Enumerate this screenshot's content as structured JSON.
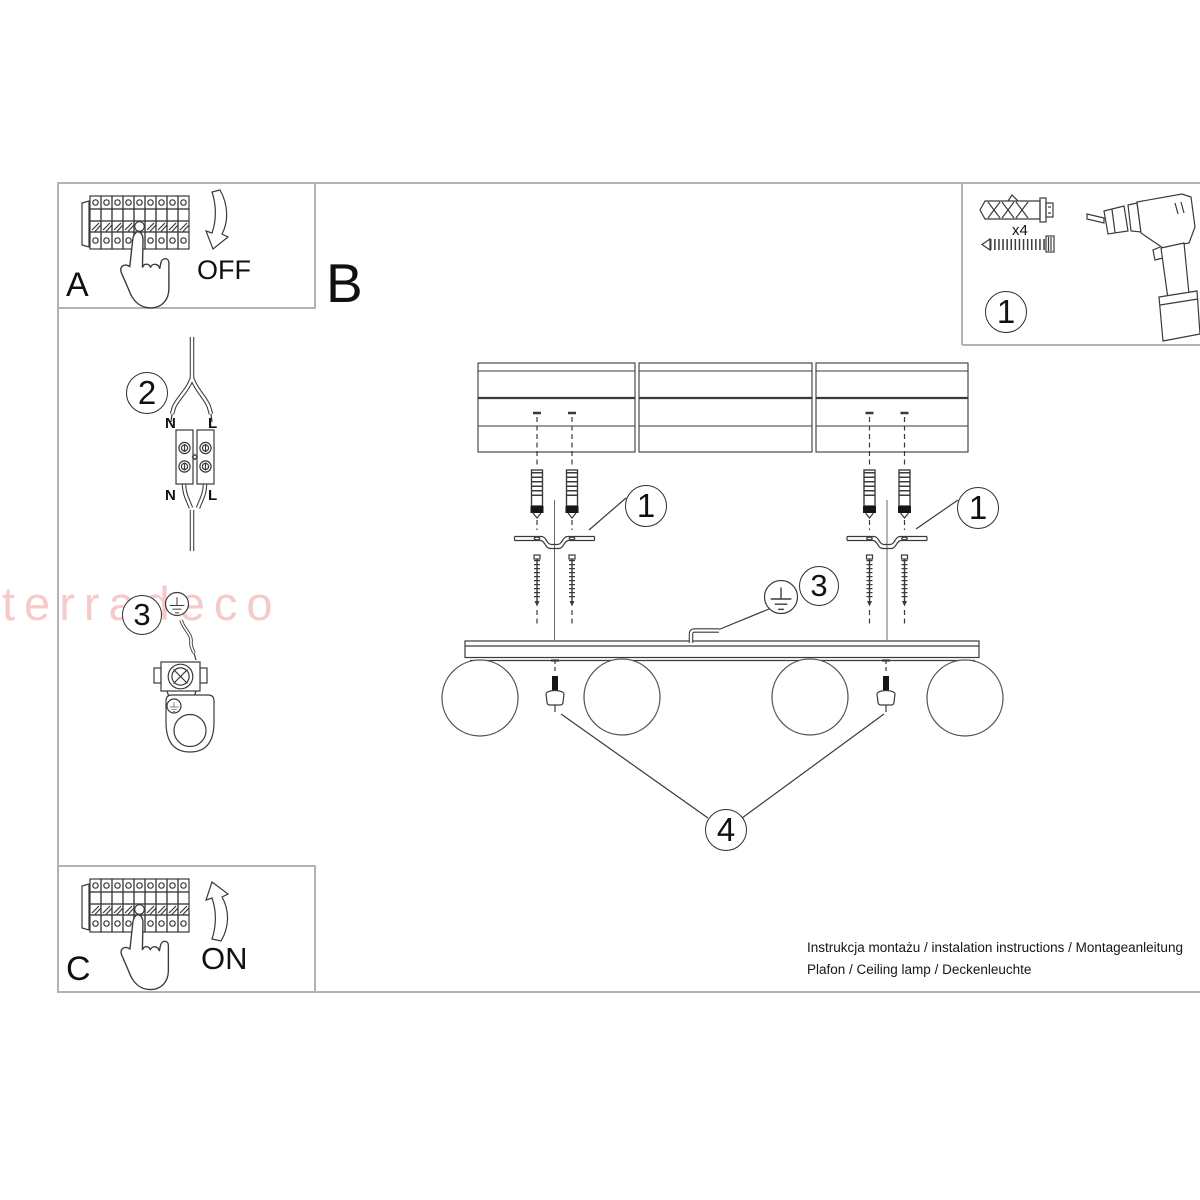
{
  "document": {
    "watermark": "terradeco",
    "footer": {
      "line1": "Instrukcja montażu / instalation instructions / Montageanleitung",
      "line2": "Plafon / Ceiling lamp / Deckenleuchte"
    }
  },
  "steps": {
    "a": {
      "label": "A",
      "breaker_state": "OFF"
    },
    "b": {
      "label": "B"
    },
    "c": {
      "label": "C",
      "breaker_state": "ON"
    }
  },
  "parts_box": {
    "callout": "1",
    "anchor_quantity": "x4"
  },
  "callouts": {
    "mounting_left": "1",
    "mounting_right": "1",
    "ground_connection": "3",
    "globe_fixing": "4",
    "terminal_wiring": "2",
    "ground_detail": "3"
  },
  "terminal_labels": {
    "top_neutral": "N",
    "top_live": "L",
    "bottom_neutral": "N",
    "bottom_live": "L"
  },
  "colors": {
    "frame": "#b3b3b3",
    "line": "#3a3a3a",
    "watermark": "#f7caca"
  }
}
